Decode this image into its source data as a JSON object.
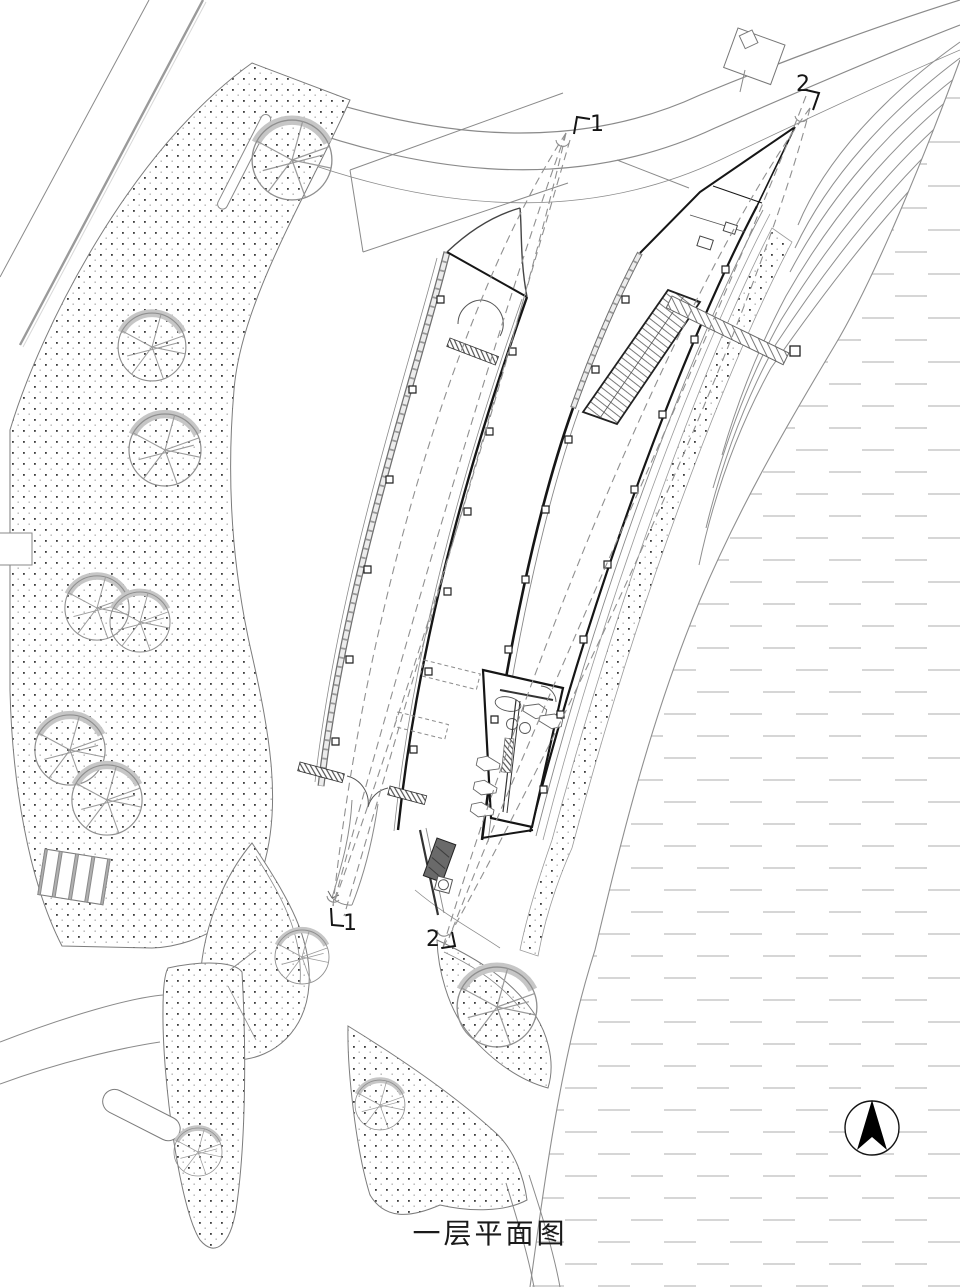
{
  "drawing": {
    "title": "一层平面图",
    "section_markers": {
      "top_1": "1",
      "top_2": "2",
      "bottom_1": "1",
      "bottom_2": "2"
    },
    "icons": {
      "north_arrow": "north-arrow-compass"
    },
    "colors": {
      "background": "#ffffff",
      "site_line": "#8a8a8a",
      "wall_line": "#141414",
      "water_dash": "#c9c9c9",
      "stipple_dot": "#3c3c3c",
      "tree_shadow": "#c6c6c6"
    }
  }
}
